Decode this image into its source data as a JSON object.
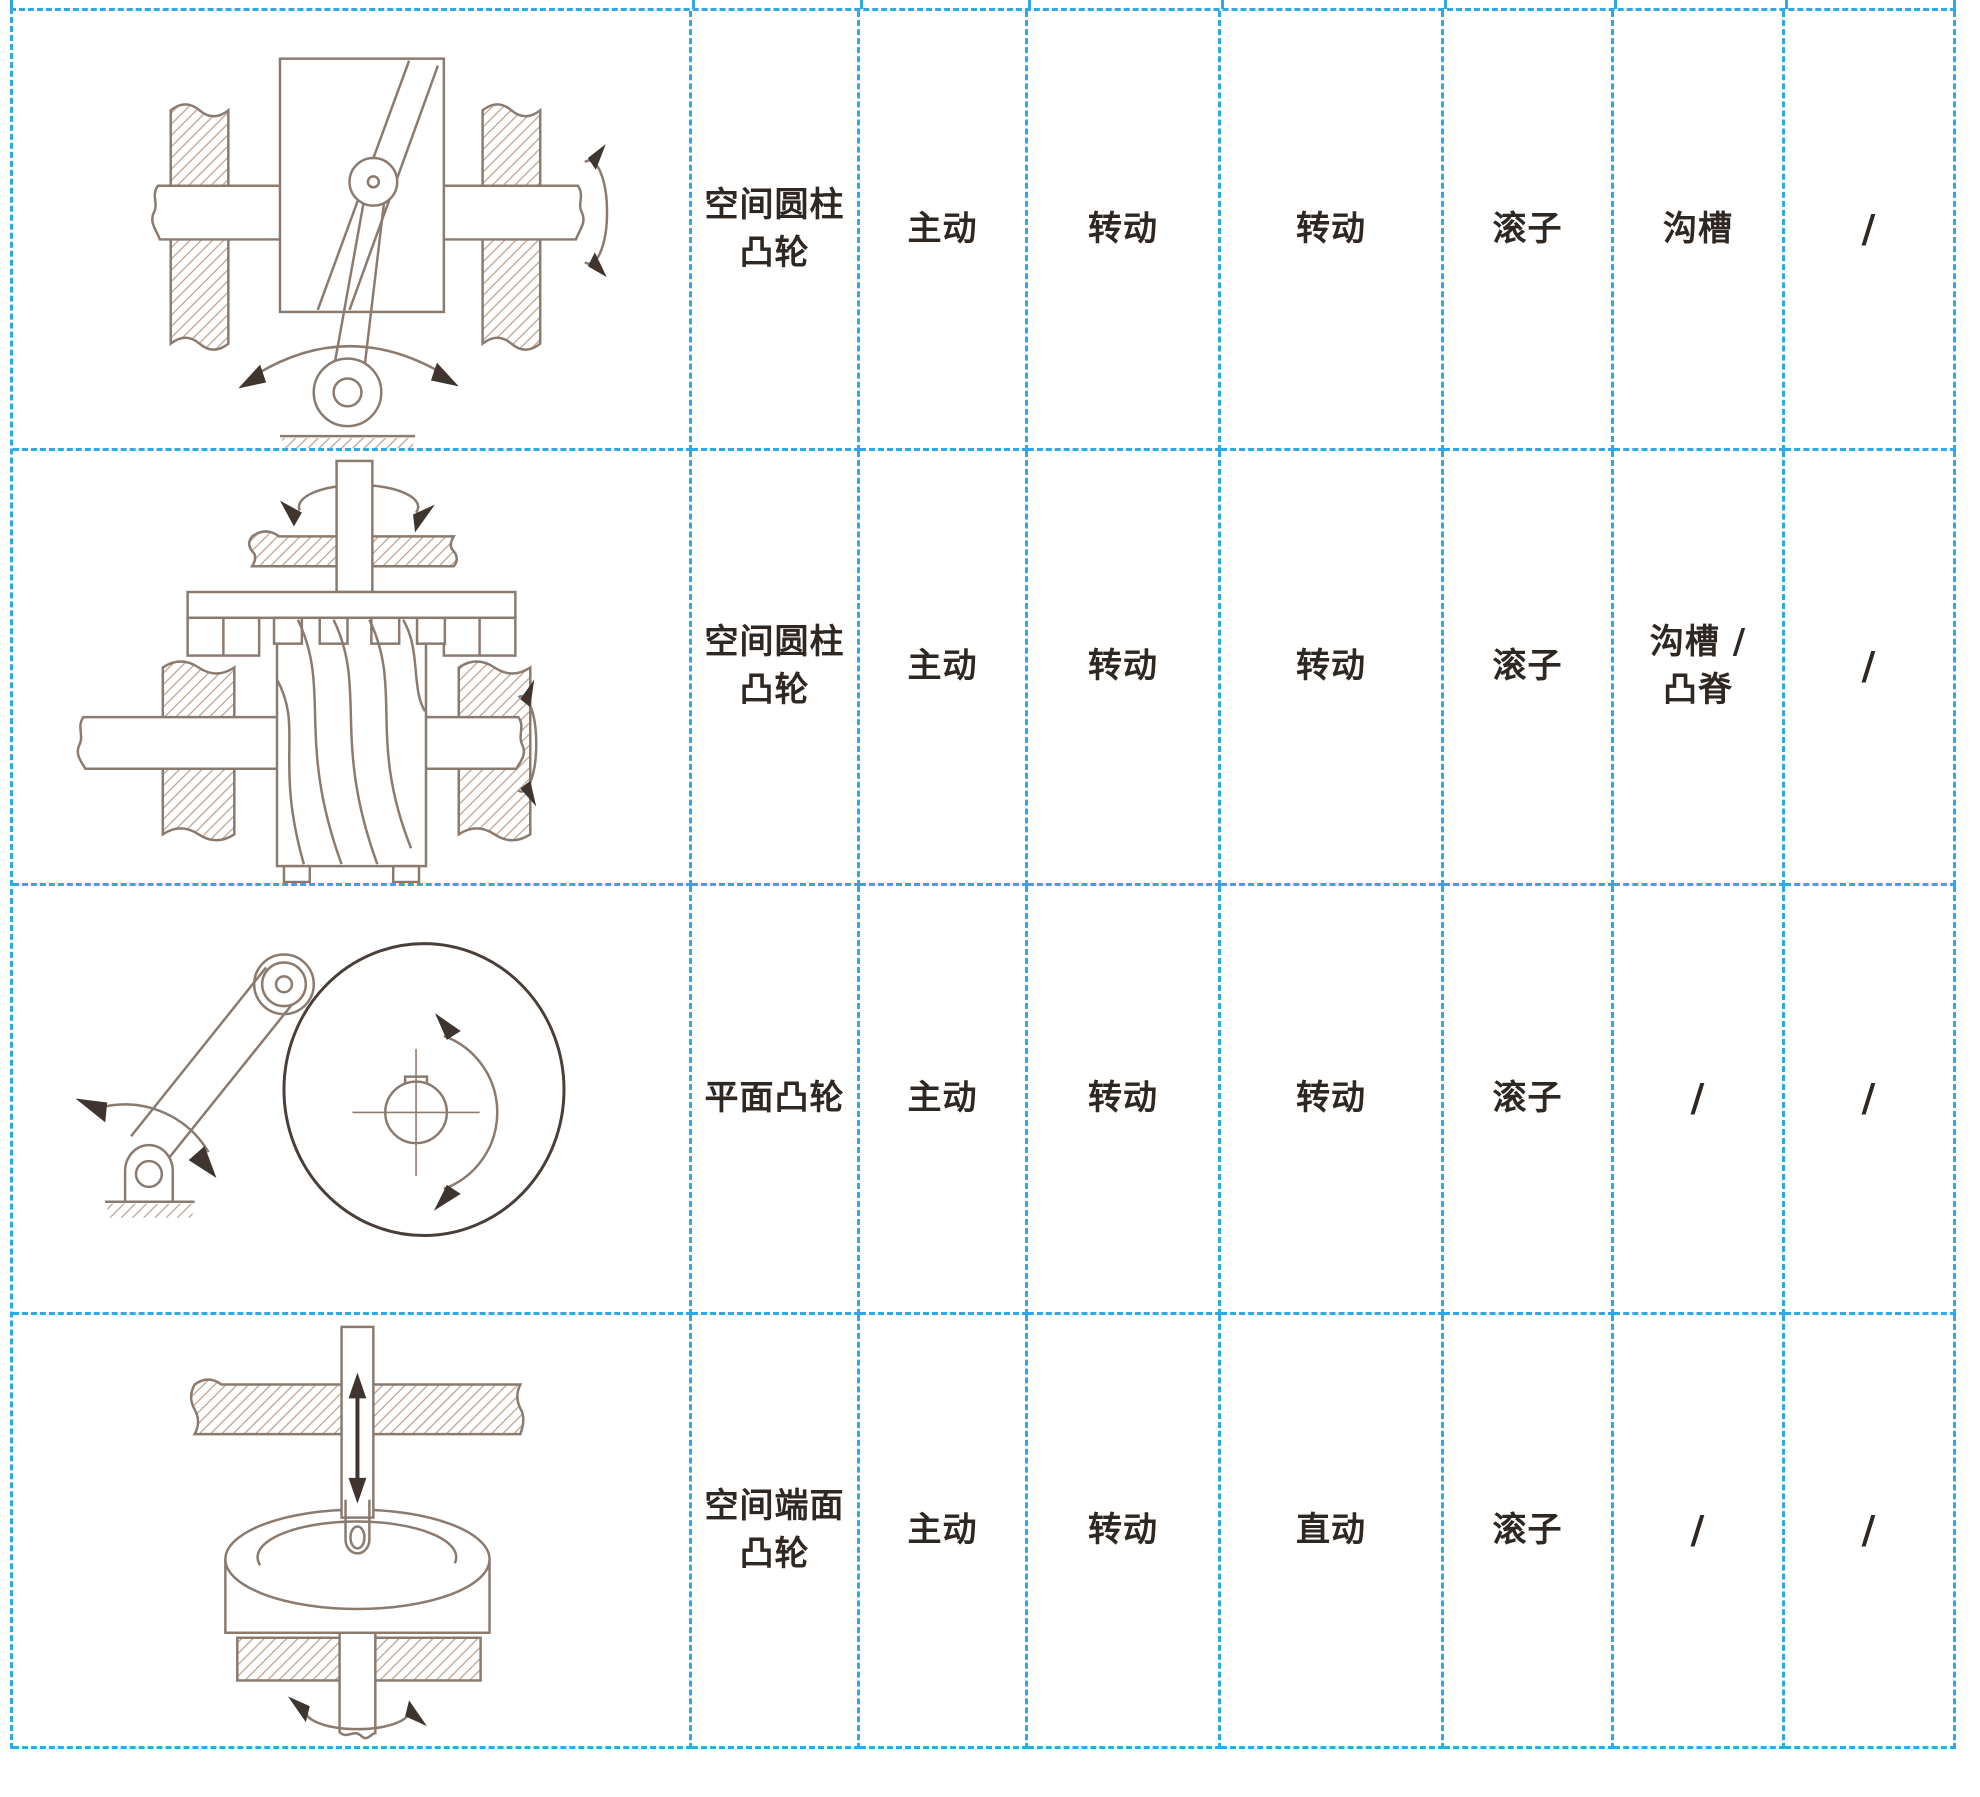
{
  "page": {
    "background_color": "#ffffff",
    "grid_line_color": "#2ea9e6",
    "text_color": "#2e2722",
    "drawing_line_color": "#8b7a6e",
    "drawing_dark_color": "#3f352e",
    "hatch_color": "#bda592"
  },
  "table": {
    "rows": [
      {
        "drawing": "spatial-cylindrical-cam-oscillating-follower-diagram",
        "name": "空间圆柱\n凸轮",
        "cells": [
          "主动",
          "转动",
          "转动",
          "滚子",
          "沟槽",
          "/"
        ]
      },
      {
        "drawing": "spatial-cylindrical-cam-helical-groove-diagram",
        "name": "空间圆柱\n凸轮",
        "cells": [
          "主动",
          "转动",
          "转动",
          "滚子",
          "沟槽 /\n凸脊",
          "/"
        ]
      },
      {
        "drawing": "planar-disc-cam-oscillating-follower-diagram",
        "name": "平面凸轮",
        "cells": [
          "主动",
          "转动",
          "转动",
          "滚子",
          "/",
          "/"
        ]
      },
      {
        "drawing": "spatial-end-face-cam-diagram",
        "name": "空间端面\n凸轮",
        "cells": [
          "主动",
          "转动",
          "直动",
          "滚子",
          "/",
          "/"
        ]
      }
    ]
  }
}
